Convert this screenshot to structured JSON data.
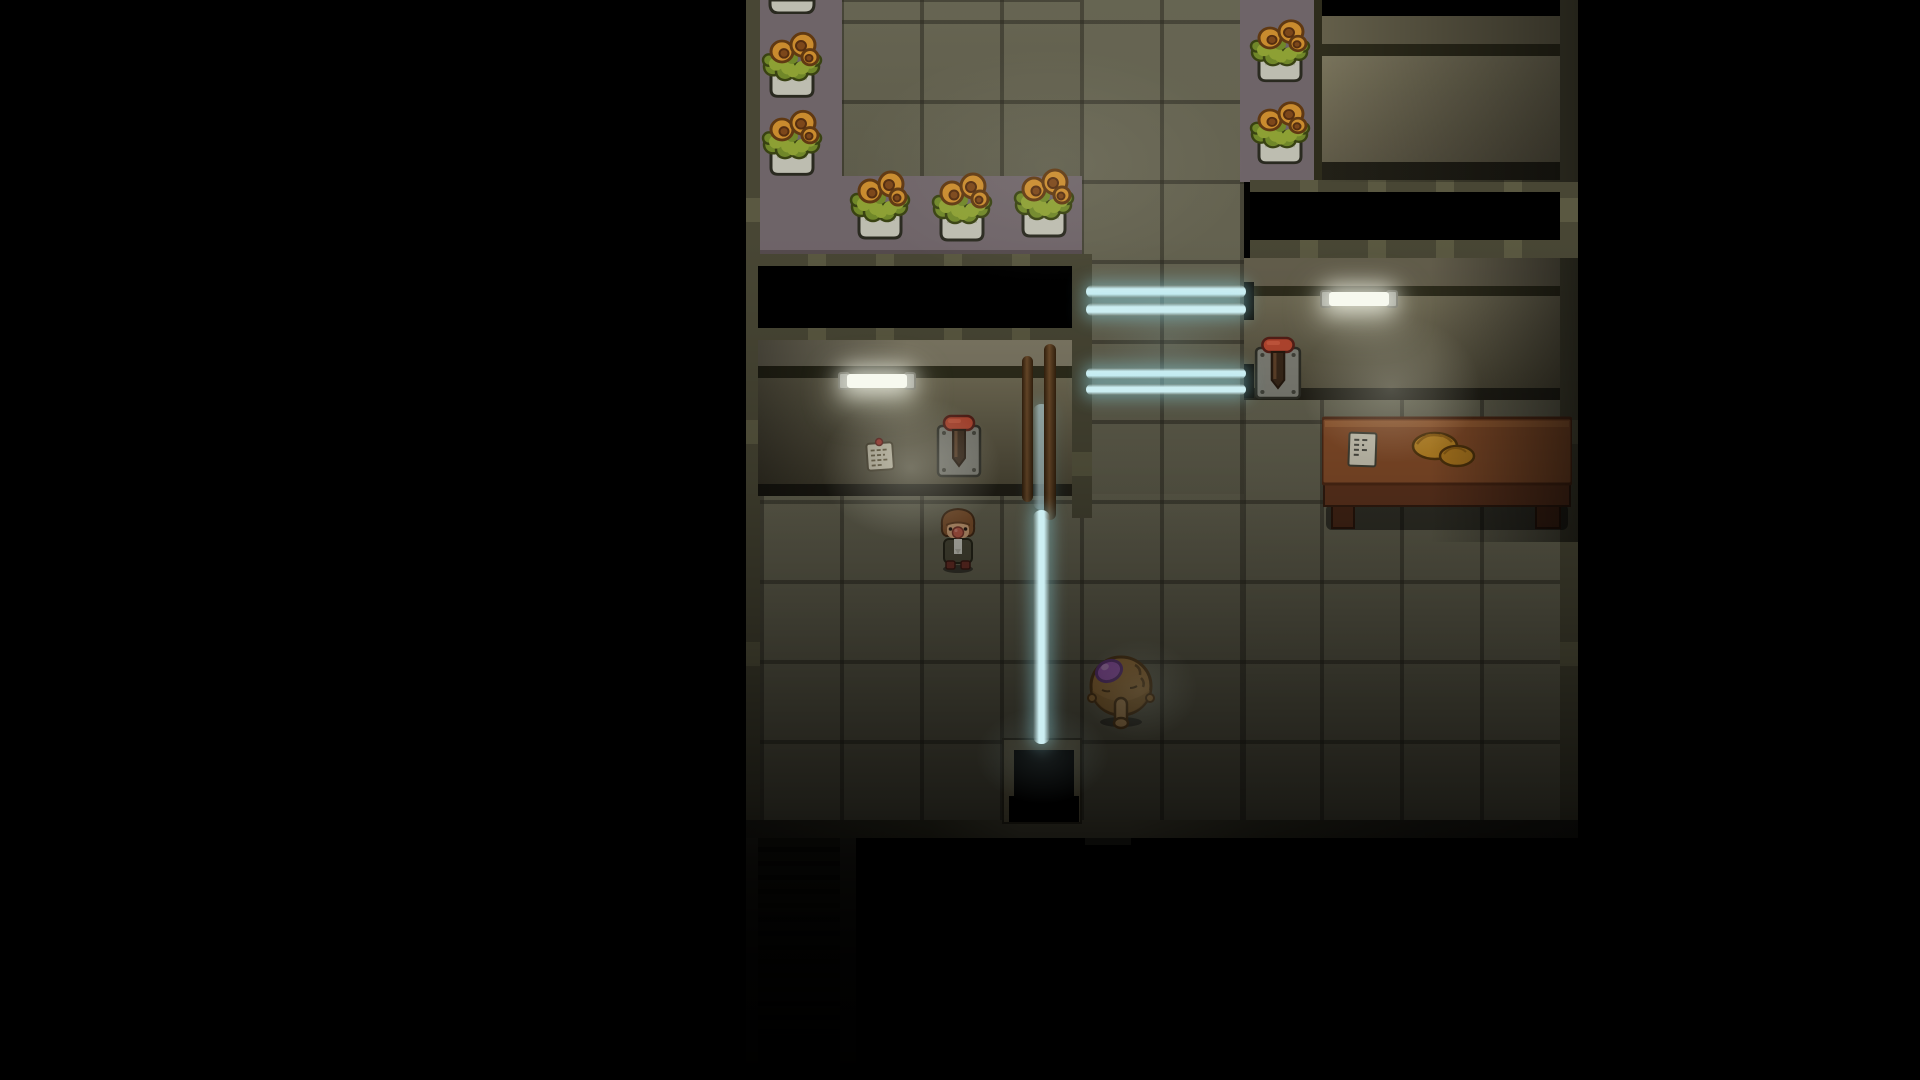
{
  "meta": {
    "viewport_width": 1920,
    "viewport_height": 1080,
    "scene": "dark-interior-room"
  },
  "palette": {
    "black": "#000000",
    "floorBase": "#6f6d58",
    "counterPurple": "#7b6f74",
    "counterEdge": "#5e5356",
    "wallTopL": "#8c8670",
    "wallTopTR": "#6f6a52",
    "wallTopR": "#6e6854",
    "wallDark": "#33311f",
    "baseboard": "#26241a",
    "borderDim": "#333126",
    "slit": "#15140e",
    "potCeramic": "#d2d2c4",
    "potShade": "#bcbcac",
    "leaf": "#9db23a",
    "leafDark": "#7d962e",
    "leafOutline": "#3f4a14",
    "flower": "#e09b33",
    "flowerCenter": "#8a4f1d",
    "flowerOutline": "#6b3f14",
    "outlineDark": "#2f2f24",
    "beamCore": "#cdeff3",
    "tube": "#f7f9ef",
    "tubeCap": "#90918a",
    "paper": "#e9e2c8",
    "pin": "#c23b31",
    "leverPlate": "#8e8e84",
    "leverHandle": "#cc4f35",
    "leverSlot": "#3f2c1c",
    "deskTop": "#99582f",
    "deskFront": "#6e3c22",
    "deskLeg": "#4f2b19",
    "croissant": "#d99b2b",
    "hair": "#8d5a31",
    "skin": "#e7b687",
    "nose": "#d26752",
    "jacket": "#53513e",
    "shirt": "#e8e8dc",
    "shoe": "#76342a",
    "furBody": "#b0803f",
    "furShade": "#9c6f33",
    "furSnout": "#c79a5d",
    "furOutline": "#5c3d17",
    "gem": "#b264cd",
    "gemOutline": "#6d3a87",
    "pole": "#6e4b28"
  },
  "entities": [
    {
      "n": "greenhouse-floor",
      "t": "floor",
      "x": 840,
      "y": 0,
      "w": 242,
      "h": 182,
      "i": false
    },
    {
      "n": "corridor-floor",
      "t": "floor",
      "x": 1080,
      "y": 0,
      "w": 164,
      "h": 824,
      "i": false
    },
    {
      "n": "left-room-floor",
      "t": "floor",
      "x": 758,
      "y": 494,
      "w": 486,
      "h": 330,
      "i": false
    },
    {
      "n": "right-room-floor",
      "t": "floor",
      "x": 1244,
      "y": 396,
      "w": 318,
      "h": 428,
      "i": false
    },
    {
      "n": "greenhouse-left-counter",
      "t": "rect",
      "c": "counterPurple",
      "x": 758,
      "y": 0,
      "w": 84,
      "h": 260,
      "i": false
    },
    {
      "n": "greenhouse-bottom-counter",
      "t": "rect",
      "c": "counterPurple",
      "x": 758,
      "y": 176,
      "w": 324,
      "h": 78,
      "i": false
    },
    {
      "n": "greenhouse-counter-edge",
      "t": "rect",
      "c": "counterEdge",
      "x": 758,
      "y": 250,
      "w": 324,
      "h": 12,
      "i": false
    },
    {
      "n": "right-flower-counter",
      "t": "rect",
      "c": "counterPurple",
      "x": 1240,
      "y": 0,
      "w": 82,
      "h": 182,
      "i": false
    },
    {
      "n": "left-wall-border",
      "t": "cls",
      "k": "vborder",
      "x": 742,
      "y": 0,
      "w": 18,
      "h": 838,
      "i": false
    },
    {
      "n": "window-band-frame-top",
      "t": "cls",
      "k": "hframe",
      "x": 758,
      "y": 254,
      "w": 324,
      "h": 12,
      "i": false
    },
    {
      "n": "left-window-opening",
      "t": "rect",
      "c": "black",
      "x": 758,
      "y": 266,
      "w": 324,
      "h": 62,
      "i": false
    },
    {
      "n": "window-band-frame-bottom",
      "t": "cls",
      "k": "hframe",
      "x": 758,
      "y": 328,
      "w": 324,
      "h": 12,
      "i": false
    },
    {
      "n": "left-wall-top-stripe",
      "t": "rect",
      "c": "wallTopL",
      "x": 758,
      "y": 340,
      "w": 334,
      "h": 26,
      "i": false
    },
    {
      "n": "left-wall-dark-stripe",
      "t": "rect",
      "c": "wallDark",
      "x": 758,
      "y": 366,
      "w": 334,
      "h": 12,
      "i": false
    },
    {
      "n": "left-wall-face",
      "t": "cls",
      "k": "faceL",
      "x": 758,
      "y": 378,
      "w": 334,
      "h": 106,
      "i": false
    },
    {
      "n": "left-wall-baseboard",
      "t": "rect",
      "c": "baseboard",
      "x": 758,
      "y": 484,
      "w": 334,
      "h": 12,
      "i": false
    },
    {
      "n": "left-room-east-border",
      "t": "cls",
      "k": "vborder",
      "x": 1072,
      "y": 254,
      "w": 20,
      "h": 264,
      "i": false
    },
    {
      "n": "alcove-top-shadow",
      "t": "rect",
      "c": "black",
      "x": 1320,
      "y": 0,
      "w": 258,
      "h": 16,
      "i": false
    },
    {
      "n": "alcove-wall-stripe",
      "t": "rect",
      "c": "wallTopTR",
      "x": 1320,
      "y": 16,
      "w": 258,
      "h": 28,
      "i": false
    },
    {
      "n": "alcove-dark-stripe",
      "t": "rect",
      "c": "wallDark",
      "x": 1320,
      "y": 44,
      "w": 258,
      "h": 12,
      "i": false
    },
    {
      "n": "alcove-counter-face",
      "t": "cls",
      "k": "faceTR",
      "x": 1320,
      "y": 56,
      "w": 258,
      "h": 106,
      "i": false
    },
    {
      "n": "alcove-baseboard",
      "t": "rect",
      "c": "baseboard",
      "x": 1320,
      "y": 162,
      "w": 258,
      "h": 18,
      "i": false
    },
    {
      "n": "alcove-left-edge",
      "t": "rect",
      "c": "wallDark",
      "x": 1314,
      "y": 0,
      "w": 8,
      "h": 182,
      "i": false
    },
    {
      "n": "right-window-frame-top",
      "t": "cls",
      "k": "hframe",
      "x": 1250,
      "y": 180,
      "w": 328,
      "h": 12,
      "i": false
    },
    {
      "n": "right-window-opening",
      "t": "rect",
      "c": "black",
      "x": 1250,
      "y": 192,
      "w": 328,
      "h": 48,
      "i": false
    },
    {
      "n": "right-window-frame-bottom",
      "t": "cls",
      "k": "hframe",
      "x": 1250,
      "y": 240,
      "w": 328,
      "h": 18,
      "i": false
    },
    {
      "n": "right-wall-top-stripe",
      "t": "rect",
      "c": "wallTopR",
      "x": 1244,
      "y": 258,
      "w": 334,
      "h": 28,
      "i": false
    },
    {
      "n": "right-wall-dark-stripe",
      "t": "rect",
      "c": "wallDark",
      "x": 1244,
      "y": 286,
      "w": 334,
      "h": 10,
      "i": false
    },
    {
      "n": "right-wall-face",
      "t": "cls",
      "k": "faceR",
      "x": 1244,
      "y": 296,
      "w": 334,
      "h": 92,
      "i": false
    },
    {
      "n": "right-wall-baseboard",
      "t": "rect",
      "c": "baseboard",
      "x": 1244,
      "y": 388,
      "w": 334,
      "h": 12,
      "i": false
    },
    {
      "n": "beam-slit-upper",
      "t": "rect",
      "c": "slit",
      "x": 1244,
      "y": 282,
      "w": 10,
      "h": 38,
      "i": false
    },
    {
      "n": "beam-slit-lower",
      "t": "rect",
      "c": "slit",
      "x": 1244,
      "y": 364,
      "w": 10,
      "h": 34,
      "i": false
    },
    {
      "n": "scene-east-border",
      "t": "cls",
      "k": "vborder",
      "x": 1560,
      "y": 0,
      "w": 20,
      "h": 838,
      "i": false
    },
    {
      "n": "desk",
      "t": "desk",
      "x": 1322,
      "y": 416,
      "w": 250,
      "h": 126,
      "i": false
    },
    {
      "n": "flower-pot-partial",
      "t": "potb",
      "x": 768,
      "y": 0,
      "w": 48,
      "h": 14,
      "i": false
    },
    {
      "n": "flower-pot",
      "t": "pot",
      "x": 760,
      "y": 20,
      "w": 64,
      "h": 84,
      "i": false
    },
    {
      "n": "flower-pot",
      "t": "pot",
      "x": 760,
      "y": 98,
      "w": 64,
      "h": 84,
      "i": false
    },
    {
      "n": "flower-pot",
      "t": "pot",
      "x": 848,
      "y": 158,
      "w": 64,
      "h": 88,
      "i": false
    },
    {
      "n": "flower-pot",
      "t": "pot",
      "x": 930,
      "y": 160,
      "w": 64,
      "h": 88,
      "i": false
    },
    {
      "n": "flower-pot",
      "t": "pot",
      "x": 1012,
      "y": 156,
      "w": 64,
      "h": 88,
      "i": false
    },
    {
      "n": "flower-pot",
      "t": "pot",
      "x": 1248,
      "y": 8,
      "w": 64,
      "h": 80,
      "i": false
    },
    {
      "n": "flower-pot",
      "t": "pot",
      "x": 1248,
      "y": 90,
      "w": 64,
      "h": 80,
      "i": false
    },
    {
      "n": "note-on-wall",
      "t": "note",
      "x": 862,
      "y": 436,
      "w": 36,
      "h": 38,
      "i": true
    },
    {
      "n": "wall-lever-left",
      "t": "lever",
      "x": 934,
      "y": 414,
      "w": 50,
      "h": 66,
      "i": true
    },
    {
      "n": "wall-lever-right",
      "t": "lever",
      "x": 1252,
      "y": 336,
      "w": 52,
      "h": 66,
      "i": true
    },
    {
      "n": "light-beam-vertical-upper",
      "t": "cls",
      "k": "beamVu",
      "x": 1033,
      "y": 404,
      "w": 17,
      "h": 106,
      "i": false
    },
    {
      "n": "pole",
      "t": "pole",
      "x": 1022,
      "y": 356,
      "w": 11,
      "h": 146,
      "i": false
    },
    {
      "n": "pole",
      "t": "pole",
      "x": 1044,
      "y": 344,
      "w": 12,
      "h": 176,
      "i": false
    },
    {
      "n": "player-character",
      "t": "character",
      "x": 934,
      "y": 506,
      "w": 48,
      "h": 68,
      "i": false
    },
    {
      "n": "south-wall",
      "t": "cls",
      "k": "southwall",
      "x": 746,
      "y": 820,
      "w": 832,
      "h": 18,
      "i": false
    },
    {
      "n": "south-wall-tab",
      "t": "rect",
      "c": "borderDim",
      "x": 1085,
      "y": 838,
      "w": 46,
      "h": 7,
      "i": false
    },
    {
      "n": "doorway",
      "t": "door",
      "x": 1002,
      "y": 738,
      "w": 80,
      "h": 86,
      "i": true
    },
    {
      "n": "stairs",
      "t": "cls",
      "k": "stairs",
      "x": 758,
      "y": 838,
      "w": 84,
      "h": 242,
      "i": false
    },
    {
      "n": "stairs-border-left",
      "t": "rect",
      "c": "borderDim",
      "x": 746,
      "y": 838,
      "w": 12,
      "h": 242,
      "i": false
    },
    {
      "n": "stairs-border-right",
      "t": "rect",
      "c": "borderDim",
      "x": 840,
      "y": 838,
      "w": 16,
      "h": 242,
      "i": false
    },
    {
      "n": "stairs-fade",
      "t": "cls",
      "k": "stairfade",
      "x": 746,
      "y": 838,
      "w": 110,
      "h": 242,
      "i": false
    },
    {
      "n": "creature",
      "t": "creature",
      "x": 1086,
      "y": 650,
      "w": 70,
      "h": 80,
      "i": true
    },
    {
      "n": "mask-left",
      "t": "rect",
      "c": "black",
      "x": 0,
      "y": 0,
      "w": 746,
      "h": 1080,
      "i": false
    },
    {
      "n": "mask-right",
      "t": "rect",
      "c": "black",
      "x": 1578,
      "y": 0,
      "w": 342,
      "h": 1080,
      "i": false
    },
    {
      "n": "mask-bottom",
      "t": "rect",
      "c": "black",
      "x": 856,
      "y": 846,
      "w": 722,
      "h": 234,
      "i": false
    },
    {
      "n": "darkness-overlay",
      "t": "cls",
      "k": "dark",
      "x": 746,
      "y": 0,
      "w": 832,
      "h": 1080,
      "i": false
    },
    {
      "n": "shade-alcove",
      "t": "cls",
      "k": "shadeR",
      "x": 1320,
      "y": 0,
      "w": 258,
      "h": 182,
      "i": false
    },
    {
      "n": "shade-left-wall",
      "t": "cls",
      "k": "shadeL",
      "x": 758,
      "y": 340,
      "w": 150,
      "h": 156,
      "i": false
    },
    {
      "n": "shade-right-wall",
      "t": "cls",
      "k": "shadeR2",
      "x": 1430,
      "y": 258,
      "w": 148,
      "h": 284,
      "i": false
    },
    {
      "n": "fluorescent-light-left",
      "t": "light",
      "x": 838,
      "y": 368,
      "w": 78,
      "h": 26,
      "i": false
    },
    {
      "n": "fluorescent-light-right",
      "t": "light",
      "x": 1320,
      "y": 286,
      "w": 78,
      "h": 26,
      "i": false
    },
    {
      "n": "light-beam",
      "t": "cls",
      "k": "beamH",
      "x": 1086,
      "y": 285,
      "w": 160,
      "h": 13,
      "i": false
    },
    {
      "n": "light-beam",
      "t": "cls",
      "k": "beamH",
      "x": 1086,
      "y": 303,
      "w": 160,
      "h": 13,
      "i": false
    },
    {
      "n": "light-beam",
      "t": "cls",
      "k": "beamH",
      "x": 1086,
      "y": 368,
      "w": 160,
      "h": 11,
      "i": false
    },
    {
      "n": "light-beam",
      "t": "cls",
      "k": "beamH",
      "x": 1086,
      "y": 384,
      "w": 160,
      "h": 11,
      "i": false
    },
    {
      "n": "light-beam-vertical",
      "t": "cls",
      "k": "beamV",
      "x": 1033,
      "y": 510,
      "w": 17,
      "h": 234,
      "i": false
    },
    {
      "n": "light-glow",
      "t": "glow",
      "v": "rgba(246,248,232,0.28)",
      "x": 786,
      "y": 368,
      "w": 250,
      "h": 200,
      "i": false
    },
    {
      "n": "light-glow",
      "t": "glow",
      "v": "rgba(246,248,232,0.24)",
      "x": 1266,
      "y": 286,
      "w": 250,
      "h": 205,
      "i": false
    },
    {
      "n": "light-glow",
      "t": "glow",
      "v": "rgba(255,255,240,0.07)",
      "x": 770,
      "y": 0,
      "w": 560,
      "h": 330,
      "i": false
    },
    {
      "n": "light-glow",
      "t": "glow",
      "v": "rgba(190,232,238,0.12)",
      "x": 950,
      "y": 688,
      "w": 185,
      "h": 135,
      "i": false
    },
    {
      "n": "light-glow",
      "t": "glow",
      "v": "rgba(170,222,232,0.10)",
      "x": 1076,
      "y": 258,
      "w": 185,
      "h": 165,
      "i": false
    },
    {
      "n": "light-glow",
      "t": "glow",
      "v": "rgba(210,230,220,0.10)",
      "x": 1060,
      "y": 620,
      "w": 160,
      "h": 140,
      "i": false
    }
  ]
}
